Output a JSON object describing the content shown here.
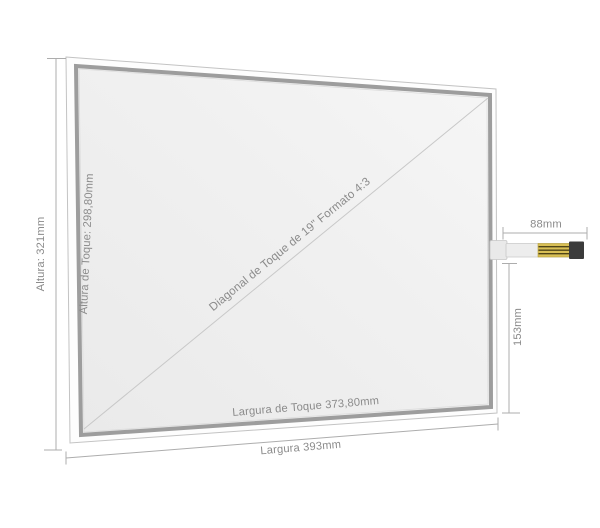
{
  "diagram": {
    "description": "Dimensional drawing of a 19-inch 4:3 resistive touch screen panel with flex cable",
    "labels": {
      "total_height": "Altura: 321mm",
      "touch_height": "Altura de Toque: 298,80mm",
      "touch_diagonal": "Diagonal de Toque de 19\" Formato 4:3",
      "touch_width": "Largura de Toque 373,80mm",
      "total_width": "Largura 393mm",
      "connector_length": "88mm",
      "connector_offset": "153mm"
    },
    "colors": {
      "background": "#ffffff",
      "glass_fill": "#fdfdfd",
      "glass_outline": "#c3c3c3",
      "touch_frame_band": "#9d9d9d",
      "panel_surface": "#efefef",
      "diagonal_line": "#c8c8c8",
      "dimension_line": "#adadad",
      "label_text": "#8b8b8b",
      "cable_body": "#ededed",
      "cable_gold": "#d8bf55",
      "cable_gold_stripe": "#4f4417",
      "cable_tip": "#3b3b3b"
    }
  }
}
